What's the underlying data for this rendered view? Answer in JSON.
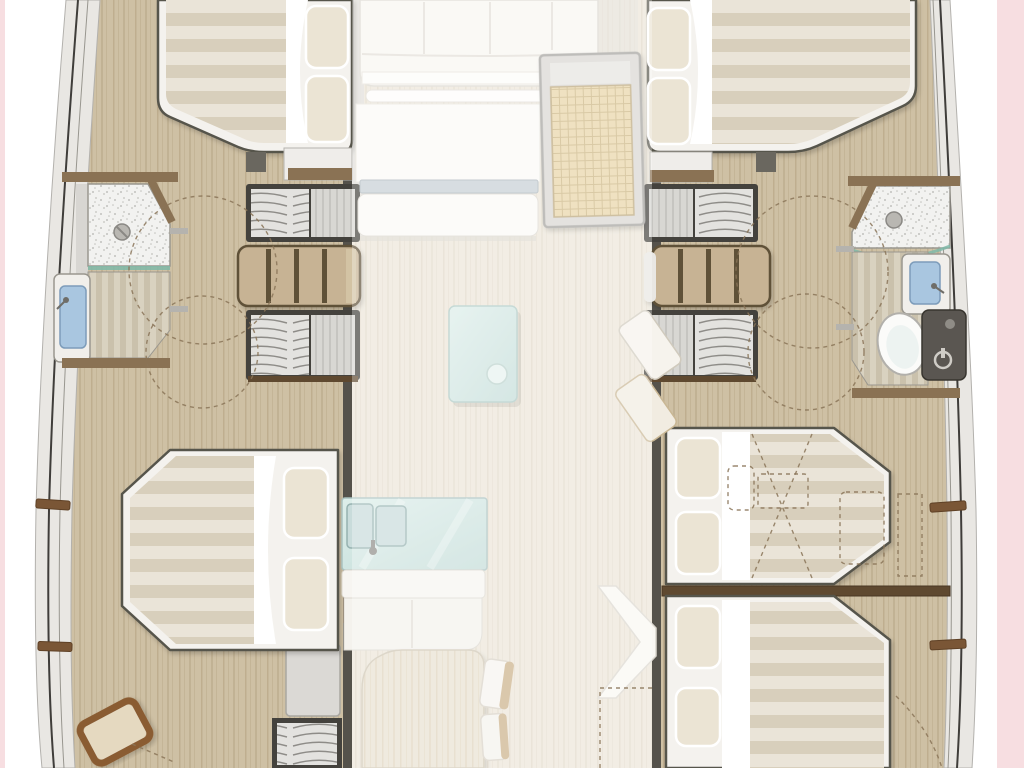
{
  "meta": {
    "title": "Catamaran yacht interior floor plan - top-down deck layout",
    "type": "boat-floor-plan",
    "view": "top-down"
  },
  "palette": {
    "page_bg": "#ffffff",
    "pink": "#f7dee1",
    "hull_band": "#e9e7e3",
    "hull_edge": "#b3b1ad",
    "hull_line_dark": "#3f3d3a",
    "hull_line_mid": "#98968f",
    "wood": "#cec0a4",
    "wood_grain": "#b9a888",
    "wood_pale": "#ece6d9",
    "wood_pale_grain": "#ddd4c2",
    "wall_dark": "#55524b",
    "wall_brown": "#8a7254",
    "wall_brown_dark": "#5f4930",
    "frame_white": "#f4f2ee",
    "outline_dark": "#57544c",
    "mat_a": "#eae4d8",
    "mat_b": "#d8cfbc",
    "sheet": "#ffffff",
    "pillow": "#ebe4d4",
    "stair_frame": "#44423d",
    "stair_bg": "#e3e2df",
    "stair_tread": "#8e8c88",
    "stair_landing": "#d8d7d3",
    "stair_landing_line": "#c6c5c1",
    "shelf_wood": "#c7b394",
    "shelf_div": "#5f5139",
    "speckle_bg": "#f2f2f0",
    "speckle_dot": "#c2c2be",
    "teak_a": "#d9d2c0",
    "teak_b": "#cac1ac",
    "glass_teal": "#7fb8a8",
    "glass_a": "#ddeeea",
    "glass_b": "#c3dcd8",
    "sink_blue": "#a9c6e0",
    "sink_blue_line": "#7d9cba",
    "toilet": "#fbfbf9",
    "dark_unit": "#5a5651",
    "mat_bg": "#e8d5a6",
    "mat_grid": "#c9b27f",
    "mat_frame": "#d8d6d2",
    "table_wood": "#e9e1d1",
    "table_wood_grain": "#dccfb6",
    "chair_back": "#cbb089",
    "dash": "#8a7458",
    "cleat": "#7a5636"
  },
  "inventory": {
    "hulls": [
      "port-hull",
      "starboard-hull"
    ],
    "cabins": [
      {
        "id": "port-forward-cabin",
        "features": [
          "double-bed",
          "two-pillows",
          "striped-mattress"
        ]
      },
      {
        "id": "starboard-forward-cabin",
        "features": [
          "double-bed",
          "two-pillows",
          "striped-mattress"
        ]
      },
      {
        "id": "port-aft-cabin",
        "features": [
          "double-bed",
          "two-pillows",
          "folding-stool"
        ]
      },
      {
        "id": "starboard-aft-cabin",
        "features": [
          "double-bed-forward",
          "double-bed-aft",
          "shelf-divider",
          "dashed-alternative-layout"
        ]
      }
    ],
    "bathrooms": [
      {
        "id": "port-bathroom",
        "features": [
          "shower",
          "drain",
          "glass-partition",
          "teak-floor",
          "sink"
        ]
      },
      {
        "id": "starboard-bathroom",
        "features": [
          "shower",
          "drain",
          "glass-partition",
          "teak-floor",
          "sink",
          "toilet",
          "dark-cabinet"
        ]
      }
    ],
    "saloon": [
      "sofa",
      "front-glass-strip",
      "entry-mat",
      "coffee-table"
    ],
    "galley": [
      "double-sink-counter",
      "white-cabinets",
      "dining-table",
      "two-chairs"
    ],
    "circulation": [
      "port-forward-stairs",
      "port-aft-stairs",
      "port-companionway",
      "starboard-forward-stairs",
      "starboard-aft-stairs",
      "door-swing-arcs",
      "hull-cleats"
    ],
    "background": {
      "left_strip": "pink",
      "right_strip": "pink",
      "page": "white"
    }
  }
}
